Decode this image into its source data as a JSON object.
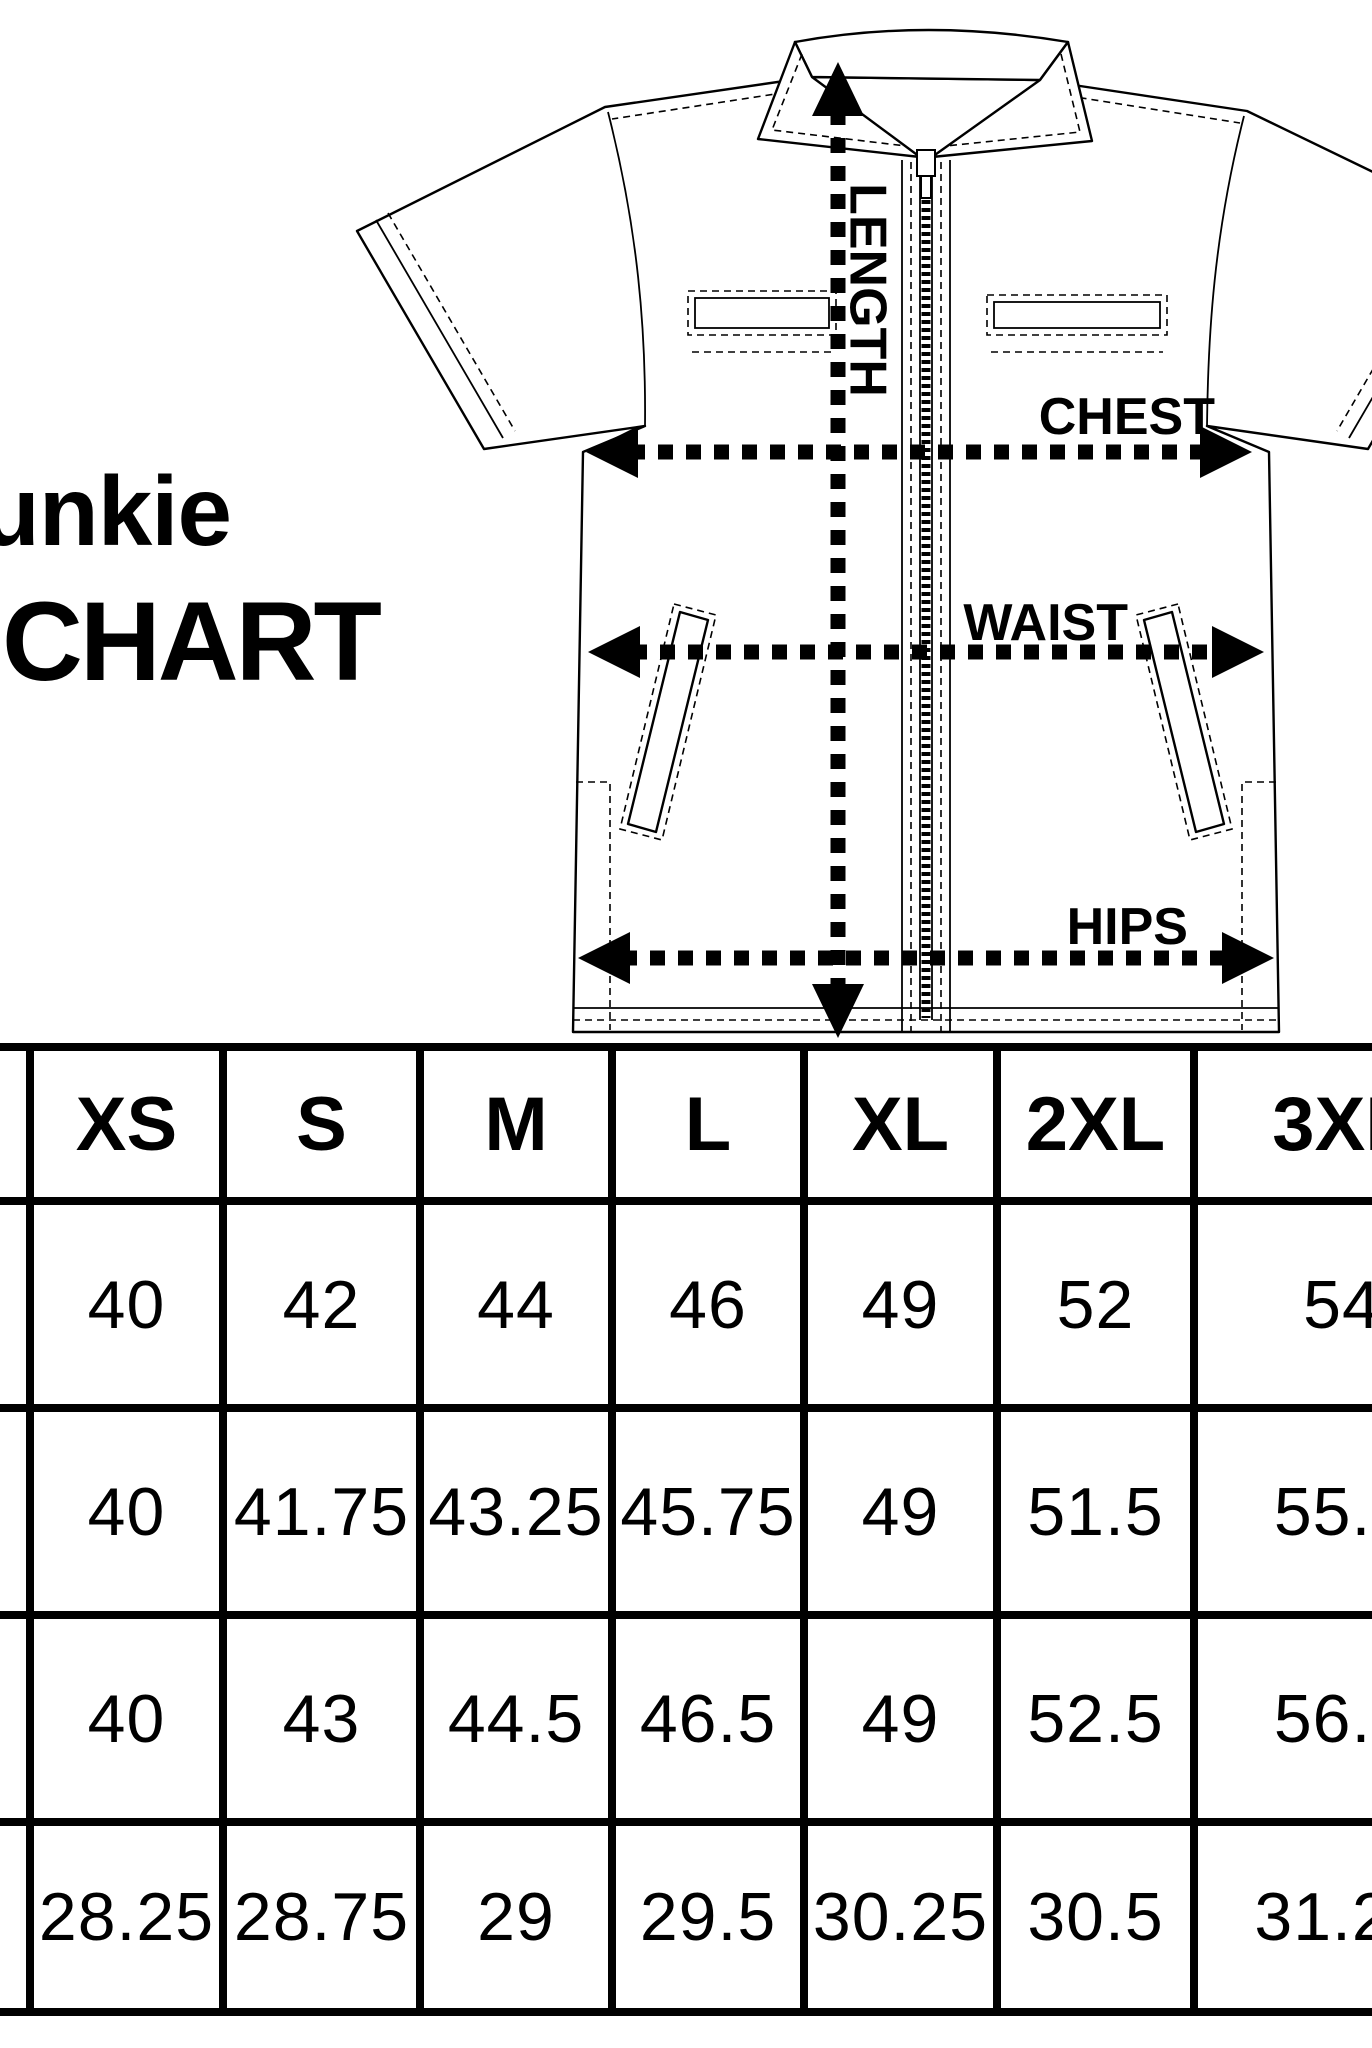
{
  "title": {
    "line1": "unkie",
    "line2": "CHART"
  },
  "diagram": {
    "labels": {
      "length": "LENGTH",
      "chest": "CHEST",
      "waist": "WAIST",
      "hips": "HIPS"
    }
  },
  "table": {
    "columns": [
      "XS",
      "S",
      "M",
      "L",
      "XL",
      "2XL",
      "3XL"
    ],
    "rows": [
      {
        "values": [
          "40",
          "42",
          "44",
          "46",
          "49",
          "52",
          "54"
        ]
      },
      {
        "values": [
          "40",
          "41.75",
          "43.25",
          "45.75",
          "49",
          "51.5",
          "55.5"
        ]
      },
      {
        "values": [
          "40",
          "43",
          "44.5",
          "46.5",
          "49",
          "52.5",
          "56.5"
        ]
      },
      {
        "values": [
          "28.25",
          "28.75",
          "29",
          "29.5",
          "30.25",
          "30.5",
          "31.25"
        ]
      }
    ]
  },
  "colors": {
    "ink": "#000000",
    "background": "#ffffff"
  }
}
